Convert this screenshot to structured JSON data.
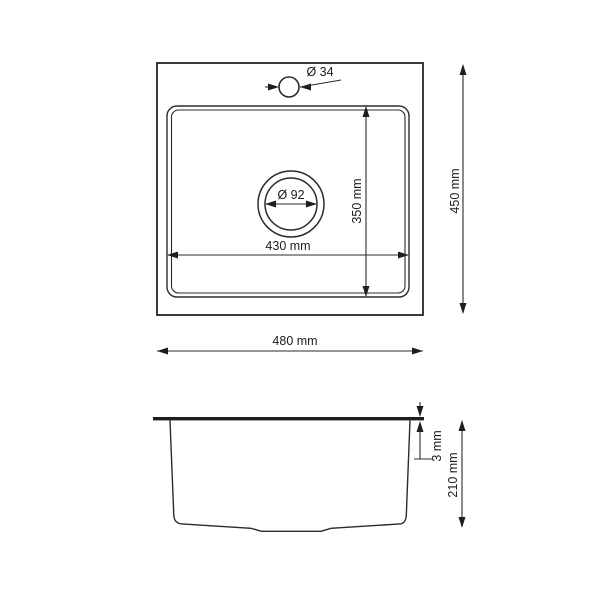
{
  "drawing": {
    "kind": "technical-dimension-drawing",
    "subject": "single-bowl kitchen sink",
    "background_color": "#ffffff",
    "line_color": "#2b2b2b",
    "text_color": "#1c1c1c",
    "top_view": {
      "faucet_hole_diameter_label": "Ø 34",
      "drain_diameter_label": "Ø 92",
      "bowl_depth_label": "350 mm",
      "bowl_width_label": "430 mm",
      "overall_width_label": "480 mm",
      "overall_depth_label": "450 mm"
    },
    "side_view": {
      "rim_thickness_label": "3 mm",
      "bowl_height_label": "210 mm"
    }
  }
}
